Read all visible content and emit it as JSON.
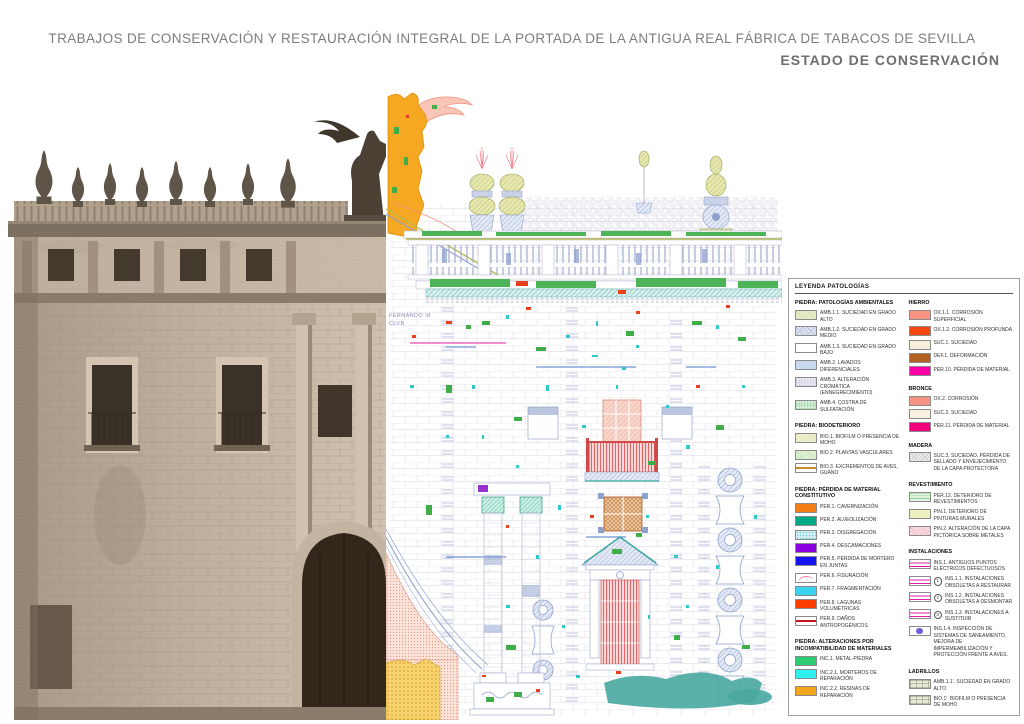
{
  "header": {
    "title": "TRABAJOS DE CONSERVACIÓN Y RESTAURACIÓN INTEGRAL DE LA PORTADA DE LA ANTIGUA REAL FÁBRICA DE TABACOS DE SEVILLA",
    "subtitle": "ESTADO DE CONSERVACIÓN",
    "title_color": "#7b7c7f",
    "subtitle_color": "#6d6e71"
  },
  "drawing": {
    "inscription_line1": "FERNANDO VI",
    "inscription_line2": "CLVB"
  },
  "legend": {
    "title": "LEYENDA PATOLOGÍAS",
    "border_color": "#9d9fa2",
    "columns": [
      {
        "sections": [
          {
            "title": "PIEDRA: PATOLOGÍAS AMBIENTALES",
            "items": [
              {
                "label": "AMB.1.1. SUCIEDAD EN GRADO ALTO",
                "swatch": {
                  "type": "diag",
                  "bg": "#e7ebc9",
                  "fg": "#ccd49e"
                }
              },
              {
                "label": "AMB.1.2. SUCIEDAD EN GRADO MEDIO",
                "swatch": {
                  "type": "crosshatch",
                  "bg": "#e3eaf6",
                  "fg": "#a9b9da"
                }
              },
              {
                "label": "AMB.1.3. SUCIEDAD EN GRADO BAJO",
                "swatch": {
                  "type": "plain",
                  "bg": "#ffffff"
                }
              },
              {
                "label": "AMB.2. LAVADOS DIFERENCIALES",
                "swatch": {
                  "type": "plain",
                  "bg": "#c9daee"
                }
              },
              {
                "label": "AMB.3. ALTERACIÓN CROMÁTICA (ENNEGRECIMIENTO)",
                "swatch": {
                  "type": "grid",
                  "bg": "#ececf4",
                  "fg": "#c8c8dc"
                }
              },
              {
                "label": "AMB.4. COSTRA DE SULFATACIÓN",
                "swatch": {
                  "type": "grid",
                  "bg": "#def1e0",
                  "fg": "#8fd4a0"
                }
              }
            ]
          },
          {
            "title": "PIEDRA: BIODETERIORO",
            "items": [
              {
                "label": "BIO.1. BIOFILM O PRESENCIA DE MOHO",
                "swatch": {
                  "type": "diag",
                  "bg": "#f0f0cf",
                  "fg": "#d9d9a4"
                }
              },
              {
                "label": "BIO.2. PLANTAS VASCULARES",
                "swatch": {
                  "type": "diag",
                  "bg": "#e2f2d8",
                  "fg": "#a9d899"
                }
              },
              {
                "label": "BIO.3. EXCREMENTOS DE AVES, GUANO",
                "swatch": {
                  "type": "hline",
                  "bg": "#ffffff",
                  "fg": "#c98a2e"
                }
              }
            ]
          },
          {
            "title": "PIEDRA: PÉRDIDA DE MATERIAL CONSTITUTIVO",
            "items": [
              {
                "label": "PER.1. CAVERNIZACIÓN",
                "swatch": {
                  "type": "plain",
                  "bg": "#f57f17"
                }
              },
              {
                "label": "PER.2. ALVEOLIZACIÓN",
                "swatch": {
                  "type": "plain",
                  "bg": "#00a884"
                }
              },
              {
                "label": "PER.3. DISGREGACIÓN",
                "swatch": {
                  "type": "speckle",
                  "bg": "#cfeef2",
                  "fg": "#5cc9d9"
                }
              },
              {
                "label": "PER.4. DESCAMACIONES",
                "swatch": {
                  "type": "plain",
                  "bg": "#8a00e0"
                }
              },
              {
                "label": "PER.5. PÉRDIDA DE MORTERO EN JUNTAS",
                "swatch": {
                  "type": "plain",
                  "bg": "#1414f0"
                }
              },
              {
                "label": "PER.6. FISURACIÓN",
                "swatch": {
                  "type": "curve",
                  "bg": "#ffffff",
                  "fg": "#f0709f"
                }
              },
              {
                "label": "PER.7. FRAGMENTACIÓN",
                "swatch": {
                  "type": "plain",
                  "bg": "#3ad3ef"
                }
              },
              {
                "label": "PER.8. LAGUNAS VOLUMÉTRICAS",
                "swatch": {
                  "type": "plain",
                  "bg": "#ff3d00"
                }
              },
              {
                "label": "PER.9. DAÑOS ANTROPOGÉNICOS",
                "swatch": {
                  "type": "hline",
                  "bg": "#ffffff",
                  "fg": "#c01824"
                }
              }
            ]
          },
          {
            "title": "PIEDRA: ALTERACIONES POR INCOMPATIBILIDAD DE MATERIALES",
            "items": [
              {
                "label": "INC.1. METAL-PIEDRA",
                "swatch": {
                  "type": "plain",
                  "bg": "#2ecc71"
                }
              },
              {
                "label": "INC.2.1. MORTEROS DE REPARACIÓN",
                "swatch": {
                  "type": "plain",
                  "bg": "#2ff0f0"
                }
              },
              {
                "label": "INC.2.2. RESINAS DE REPARACIÓN",
                "swatch": {
                  "type": "plain",
                  "bg": "#f2a71b"
                }
              }
            ]
          }
        ]
      },
      {
        "sections": [
          {
            "title": "HIERRO",
            "items": [
              {
                "label": "OX.1.1. CORROSIÓN SUPERFICIAL",
                "swatch": {
                  "type": "plain",
                  "bg": "#f59382"
                }
              },
              {
                "label": "OX.1.2. CORROSIÓN PROFUNDA",
                "swatch": {
                  "type": "plain",
                  "bg": "#f4470f"
                }
              },
              {
                "label": "SUC.1. SUCIEDAD",
                "swatch": {
                  "type": "plain",
                  "bg": "#f6efdd"
                }
              },
              {
                "label": "DEF.1. DEFORMACIÓN",
                "swatch": {
                  "type": "plain",
                  "bg": "#b35f1f"
                }
              },
              {
                "label": "PER.10. PÉRDIDA DE MATERIAL",
                "swatch": {
                  "type": "plain",
                  "bg": "#ff00a6"
                }
              }
            ]
          },
          {
            "title": "BRONCE",
            "items": [
              {
                "label": "OX.2. CORROSIÓN",
                "swatch": {
                  "type": "plain",
                  "bg": "#f59382"
                }
              },
              {
                "label": "SUC.2. SUCIEDAD",
                "swatch": {
                  "type": "plain",
                  "bg": "#f9f1e1"
                }
              },
              {
                "label": "PER.11. PÉRDIDA DE MATERIAL",
                "swatch": {
                  "type": "plain",
                  "bg": "#f2007e"
                }
              }
            ]
          },
          {
            "title": "MADERA",
            "items": [
              {
                "label": "SUC.3. SUCIEDAD, PÉRDIDA DE SELLADO Y ENVEJECIMIENTO DE LA CAPA PROTECTORA",
                "swatch": {
                  "type": "crosshatch",
                  "bg": "#f0f0f0",
                  "fg": "#c2c2c2"
                }
              }
            ]
          },
          {
            "title": "REVESTIMIENTO",
            "items": [
              {
                "label": "PER.12. DETERIORO DE REVESTIMIENTOS",
                "swatch": {
                  "type": "stripes-h",
                  "bg": "#e3f3e0",
                  "fg": "#92cf98"
                }
              },
              {
                "label": "PIN.1. DETERIORO DE PINTURAS MURALES",
                "swatch": {
                  "type": "plain",
                  "bg": "#eff0c2"
                }
              },
              {
                "label": "PIN.2. ALTERACIÓN DE LA CAPA PICTÓRICA SOBRE METALES",
                "swatch": {
                  "type": "diag",
                  "bg": "#f9dce2",
                  "fg": "#eda7b9"
                }
              }
            ]
          },
          {
            "title": "INSTALACIONES",
            "items": [
              {
                "label": "INS.1. ANTIGUOS PUNTOS ELÉCTRICOS DEFECTUOSOS",
                "swatch": {
                  "type": "lines",
                  "bg": "#ffffff",
                  "fg": "#e020a0"
                }
              },
              {
                "label": "INS.1.1. INSTALACIONES OBSOLETAS A RESTAURAR",
                "badge": "1",
                "swatch": {
                  "type": "lines",
                  "bg": "#ffffff",
                  "fg": "#e020a0"
                }
              },
              {
                "label": "INS.1.2. INSTALACIONES OBSOLETAS A DESMONTAR",
                "badge": "2",
                "swatch": {
                  "type": "lines",
                  "bg": "#ffffff",
                  "fg": "#e020a0"
                }
              },
              {
                "label": "INS.1.3. INSTALACIONES A SUSTITUIR",
                "badge": "3",
                "swatch": {
                  "type": "lines",
                  "bg": "#ffffff",
                  "fg": "#e020a0"
                }
              },
              {
                "label": "INS.1.4. INSPECCIÓN DE SISTEMAS DE SANEAMIENTO, MEJORA DE IMPERMEABILIZACIÓN Y PROTECCIÓN FRENTE A AVES.",
                "swatch": {
                  "type": "circle",
                  "bg": "#ffffff",
                  "fg": "#6a5fd8"
                }
              }
            ]
          },
          {
            "title": "LADRILLOS",
            "items": [
              {
                "label": "AMB.1.1'. SUCIEDAD EN GRADO ALTO",
                "swatch": {
                  "type": "brick",
                  "bg": "#e6e9d3",
                  "fg": "#8d927b"
                }
              },
              {
                "label": "BIO.1'. BIOFILM O PRESENCIA DE MOHO",
                "swatch": {
                  "type": "brick",
                  "bg": "#e6e9d3",
                  "fg": "#8d927b"
                }
              }
            ]
          }
        ]
      }
    ]
  }
}
